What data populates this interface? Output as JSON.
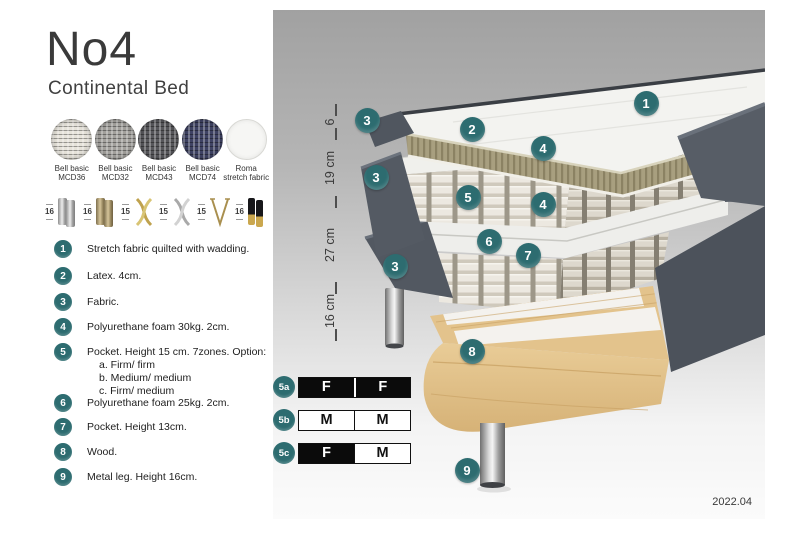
{
  "header": {
    "title": "No4",
    "subtitle": "Continental Bed"
  },
  "colors": {
    "accent": "#2d6c70",
    "fabric_dark": "#555b64",
    "latex": "#a79e7e",
    "wood": "#e3c38c"
  },
  "fabrics": [
    {
      "line1": "Bell basic",
      "line2": "MCD36"
    },
    {
      "line1": "Bell basic",
      "line2": "MCD32"
    },
    {
      "line1": "Bell basic",
      "line2": "MCD43"
    },
    {
      "line1": "Bell basic",
      "line2": "MCD74"
    },
    {
      "line1": "Roma",
      "line2": "stretch fabric"
    }
  ],
  "legs": [
    {
      "height": "16",
      "type": "round-metal-pair-chrome"
    },
    {
      "height": "16",
      "type": "round-metal-pair-brass"
    },
    {
      "height": "15",
      "type": "twisted-cross-gold"
    },
    {
      "height": "15",
      "type": "twisted-cross-silver"
    },
    {
      "height": "15",
      "type": "hairpin-metal"
    },
    {
      "height": "16",
      "type": "round-pair-black-gold-tip"
    }
  ],
  "features": [
    {
      "num": "1",
      "text": "Stretch fabric quilted with wadding."
    },
    {
      "num": "2",
      "text": "Latex. 4cm."
    },
    {
      "num": "3",
      "text": "Fabric."
    },
    {
      "num": "4",
      "text": "Polyurethane foam 30kg. 2cm."
    },
    {
      "num": "5",
      "text": "Pocket. Height 15 cm. 7zones. Option:",
      "options": [
        "a. Firm/ firm",
        "b. Medium/ medium",
        "c. Firm/ medium"
      ]
    },
    {
      "num": "6",
      "text": "Polyurethane foam 25kg. 2cm."
    },
    {
      "num": "7",
      "text": "Pocket. Height 13cm."
    },
    {
      "num": "8",
      "text": "Wood."
    },
    {
      "num": "9",
      "text": "Metal leg. Height 16cm."
    }
  ],
  "diagram": {
    "badges": [
      {
        "label": "1"
      },
      {
        "label": "2"
      },
      {
        "label": "3"
      },
      {
        "label": "3"
      },
      {
        "label": "3"
      },
      {
        "label": "4"
      },
      {
        "label": "5"
      },
      {
        "label": "4"
      },
      {
        "label": "6"
      },
      {
        "label": "7"
      },
      {
        "label": "8"
      },
      {
        "label": "9"
      }
    ],
    "ruler": [
      {
        "label": "6"
      },
      {
        "label": "19 cm"
      },
      {
        "label": "27 cm"
      },
      {
        "label": "16 cm"
      }
    ],
    "firmness": [
      {
        "id": "5a",
        "cells": [
          "F",
          "F"
        ],
        "filled": [
          true,
          true
        ]
      },
      {
        "id": "5b",
        "cells": [
          "M",
          "M"
        ],
        "filled": [
          false,
          false
        ]
      },
      {
        "id": "5c",
        "cells": [
          "F",
          "M"
        ],
        "filled": [
          true,
          false
        ]
      }
    ],
    "date": "2022.04"
  }
}
